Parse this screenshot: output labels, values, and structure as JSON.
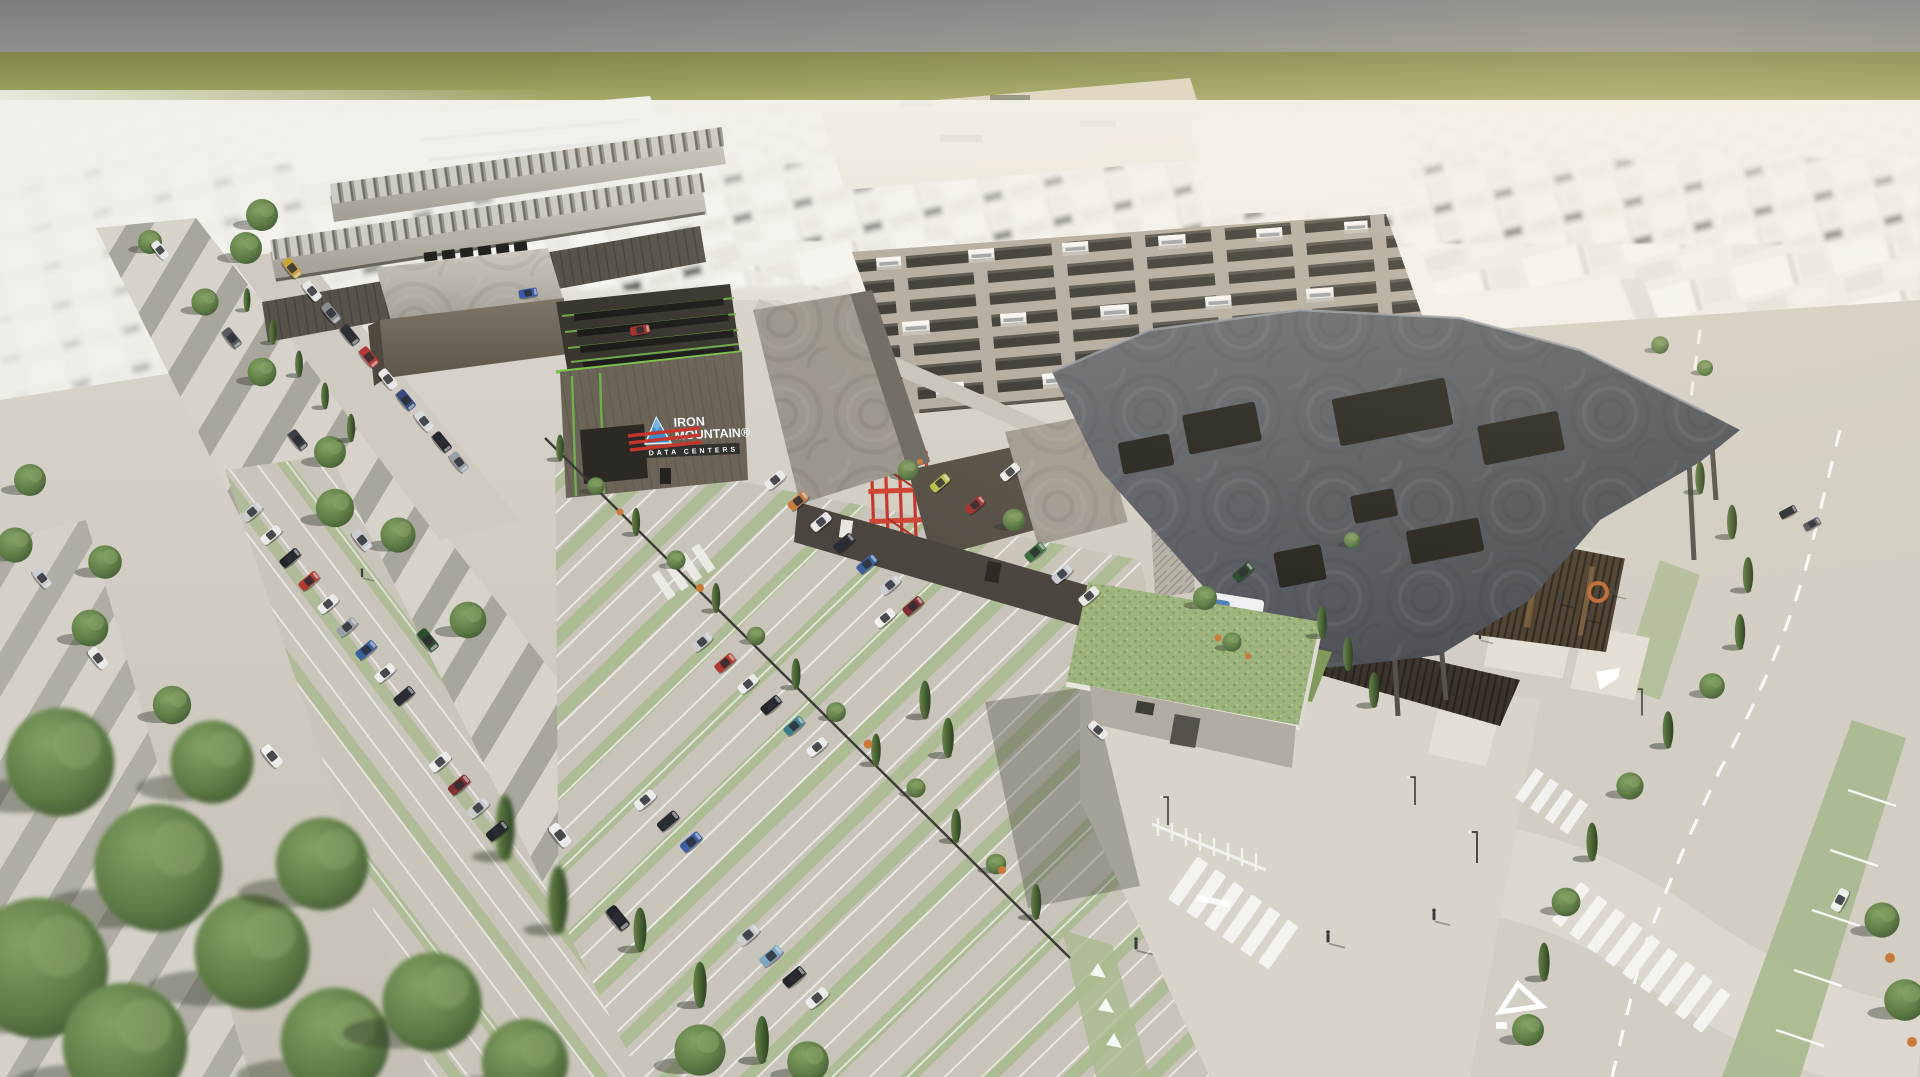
{
  "scene": {
    "description": "Aerial 3D architectural rendering of an Iron Mountain data center campus: dark bronze data halls with rooftop cooling equipment, curved gray canopy roofs, tree-lined boulevard, parking lots with cars, gatehouse with green roof, and a white low-poly city stretching to an olive horizon",
    "time_of_day": "late afternoon, long shadows toward south-west"
  },
  "logo": {
    "line1": "IRON",
    "line2": "MOUNTAIN®",
    "line3": "DATA CENTERS",
    "icon": "mountain-triangle-icon",
    "icon_color": "#3d8fd1"
  },
  "road_markings": {
    "yield_triangle_glyph": "△",
    "crosswalk_style": "white zebra bars",
    "lane_line_style": "white dashes",
    "eco_lane_color": "#a9ba8f"
  },
  "palette": {
    "sky_gray": "#7b7c80",
    "horizon_olive": "#8e9254",
    "haze_sand": "#d9cfbc",
    "city_white": "#efede8",
    "roof_gray": "#b3afa5",
    "canopy_slate": "#5a5d63",
    "facade_bronze": "#6e665a",
    "facade_dark": "#4b463f",
    "stone_pier": "#b9b4aa",
    "accent_red": "#c5372c",
    "trim_green": "#7cc14e",
    "logo_blue": "#3d8fd1",
    "road": "#d3cfc6",
    "parking_green_strip": "#a9ba8f",
    "gatehouse_roof": "#9db37c",
    "tree_dark": "#3f5531",
    "tree_mid": "#62804a"
  }
}
